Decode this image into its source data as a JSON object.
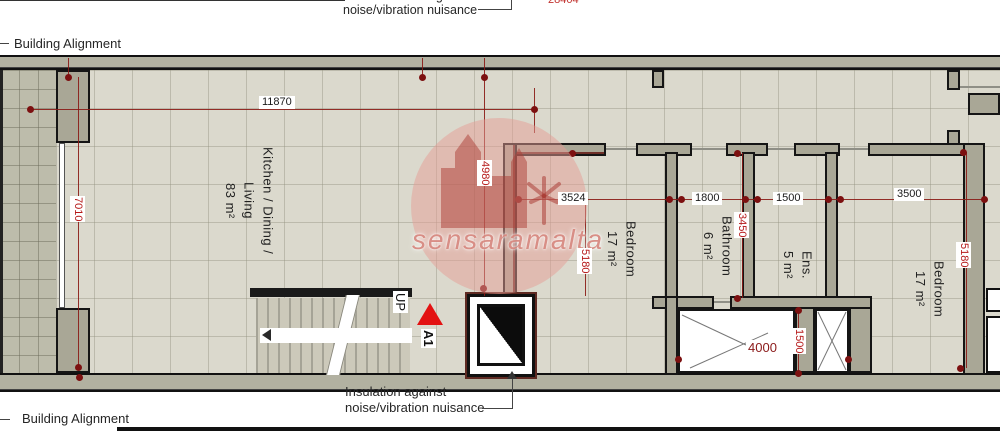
{
  "labels": {
    "building_alignment_top": "Building Alignment",
    "building_alignment_bottom": "Building Alignment",
    "insulation_line1": "Insulation against",
    "insulation_line2": "noise/vibration nuisance",
    "top_noise_text": "noise/vibration nuisance",
    "top_dimension": "28404",
    "up": "UP",
    "marker_a1": "A1",
    "watermark": "sensaramalta"
  },
  "rooms": {
    "kitchen": {
      "name": "Kitchen / Dining / Living",
      "area": "83 m²"
    },
    "bedroom1": {
      "name": "Bedroom",
      "area": "17 m²"
    },
    "bathroom": {
      "name": "Bathroom",
      "area": "6 m²"
    },
    "ensuite": {
      "name": "Ens.",
      "area": "5 m²"
    },
    "bedroom2": {
      "name": "Bedroom",
      "area": "17 m²"
    }
  },
  "dimensions": {
    "h11870": "11870",
    "h3524": "3524",
    "h1800": "1800",
    "h1500": "1500",
    "h3500": "3500",
    "h4000": "4000",
    "v7010": "7010",
    "v4980": "4980",
    "v5180_left": "5180",
    "v3450": "3450",
    "v1500": "1500",
    "v5180_right": "5180"
  },
  "colors": {
    "wall_fill": "#a9a796",
    "floor_tile": "#dbd9cd",
    "terrace_tile": "#bdbcab",
    "dimension_red": "#b51717",
    "marker_red": "#e31212",
    "watermark_pink": "#e69e96"
  }
}
